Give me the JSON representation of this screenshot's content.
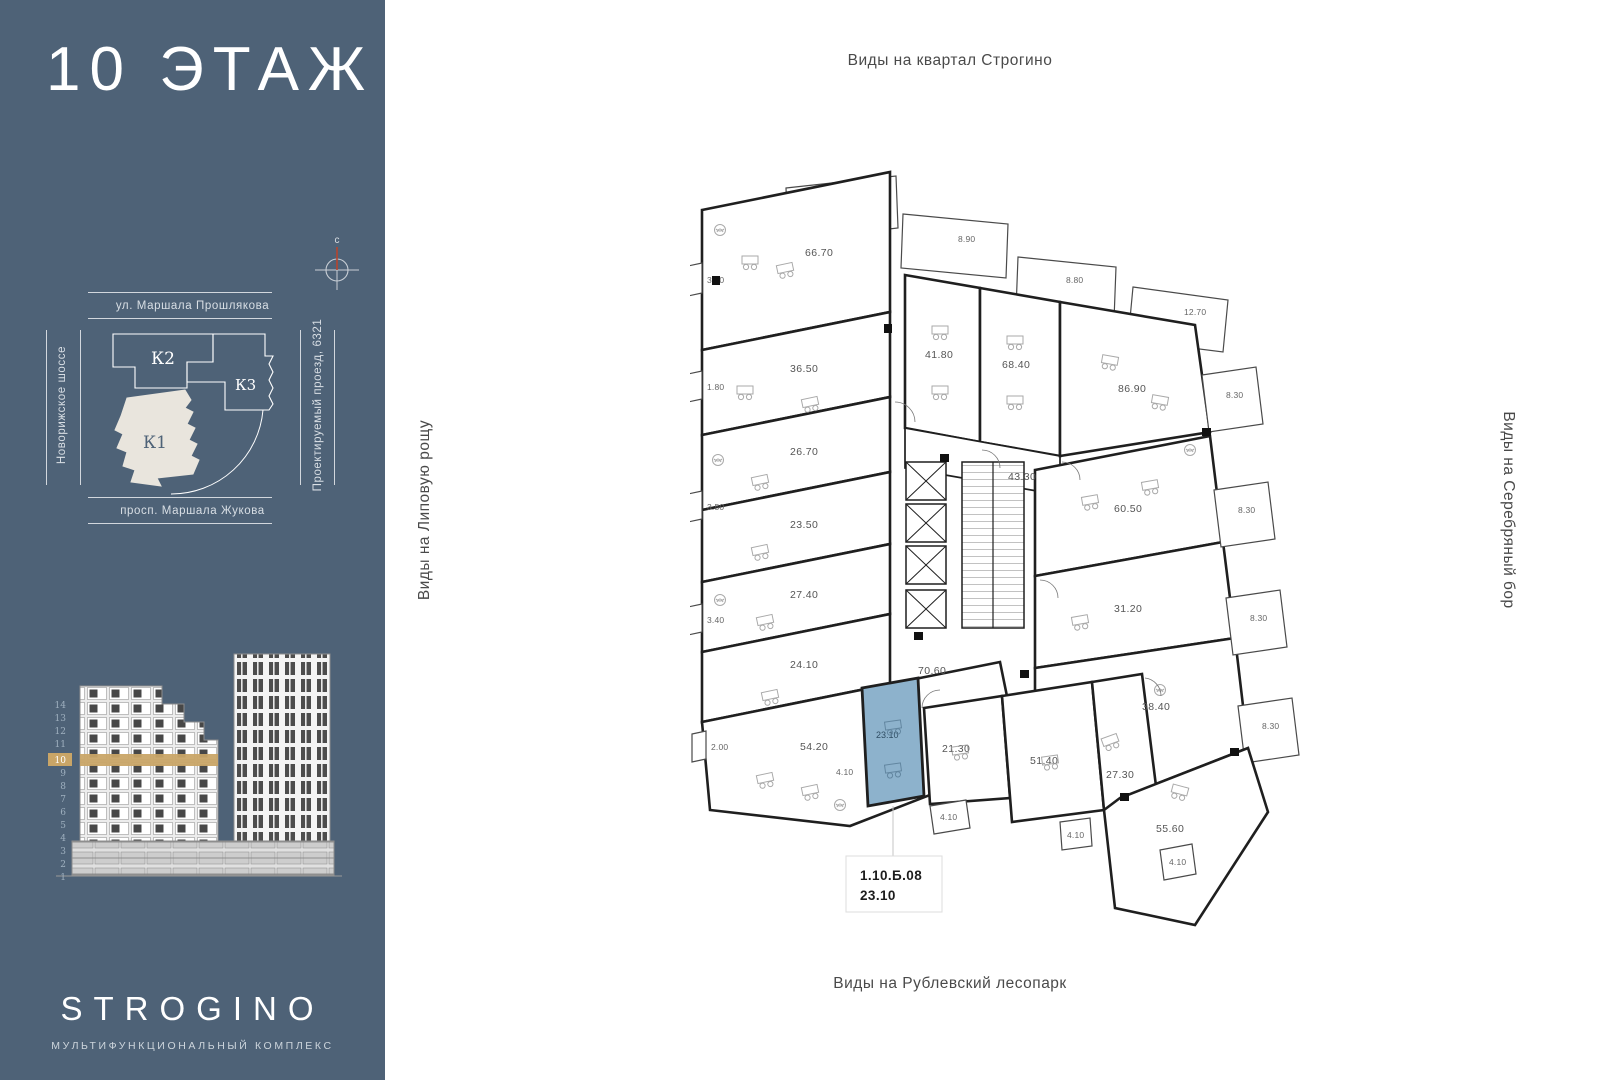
{
  "sidebar": {
    "floor_title": "10 ЭТАЖ",
    "compass_north": "с",
    "site_map": {
      "street_top": "ул. Маршала Прошлякова",
      "street_left": "Новорижское шоссе",
      "street_right": "Проектируемый проезд, 6321",
      "street_bottom": "просп. Маршала Жукова",
      "building_k1": "К1",
      "building_k2": "К2",
      "building_k3": "К3"
    },
    "elevation_floors": [
      "14",
      "13",
      "12",
      "11",
      "10",
      "9",
      "8",
      "7",
      "6",
      "5",
      "4",
      "3",
      "2",
      "1"
    ],
    "highlighted_floor": "10",
    "logo_title": "STROGINO",
    "logo_subtitle": "МУЛЬТИФУНКЦИОНАЛЬНЫЙ КОМПЛЕКС"
  },
  "main": {
    "view_top": "Виды на квартал Строгино",
    "view_left": "Виды на Липовую рощу",
    "view_right": "Виды на Серебряный бор",
    "view_bottom": "Виды на Рублевский лесопарк"
  },
  "plan": {
    "rooms": [
      {
        "area": "66.70"
      },
      {
        "area": "36.50"
      },
      {
        "area": "26.70"
      },
      {
        "area": "23.50"
      },
      {
        "area": "27.40"
      },
      {
        "area": "24.10"
      },
      {
        "area": "54.20"
      },
      {
        "area": "41.80"
      },
      {
        "area": "68.40"
      },
      {
        "area": "43.30"
      },
      {
        "area": "86.90"
      },
      {
        "area": "60.50"
      },
      {
        "area": "31.20"
      },
      {
        "area": "38.40"
      },
      {
        "area": "70.60"
      },
      {
        "area": "21.30"
      },
      {
        "area": "51.40"
      },
      {
        "area": "27.30"
      },
      {
        "area": "55.60"
      }
    ],
    "top_balconies": [
      "8.80",
      "8.90",
      "8.80",
      "12.70"
    ],
    "right_balconies": [
      "8.30",
      "8.30",
      "8.30",
      "8.30"
    ],
    "left_cells": [
      "3.40",
      "1.80",
      "3.50",
      "3.40",
      "2.00"
    ],
    "small_cells": [
      "4.10",
      "4.10",
      "4.10",
      "4.10"
    ],
    "selected_unit": {
      "number": "1.10.Б.08",
      "area": "23.10"
    }
  },
  "colors": {
    "sidebar_bg": "#4e6277",
    "accent_tan": "#c9a567",
    "selected_fill": "#8db2cc",
    "k1_fill": "#e9e5dd"
  }
}
